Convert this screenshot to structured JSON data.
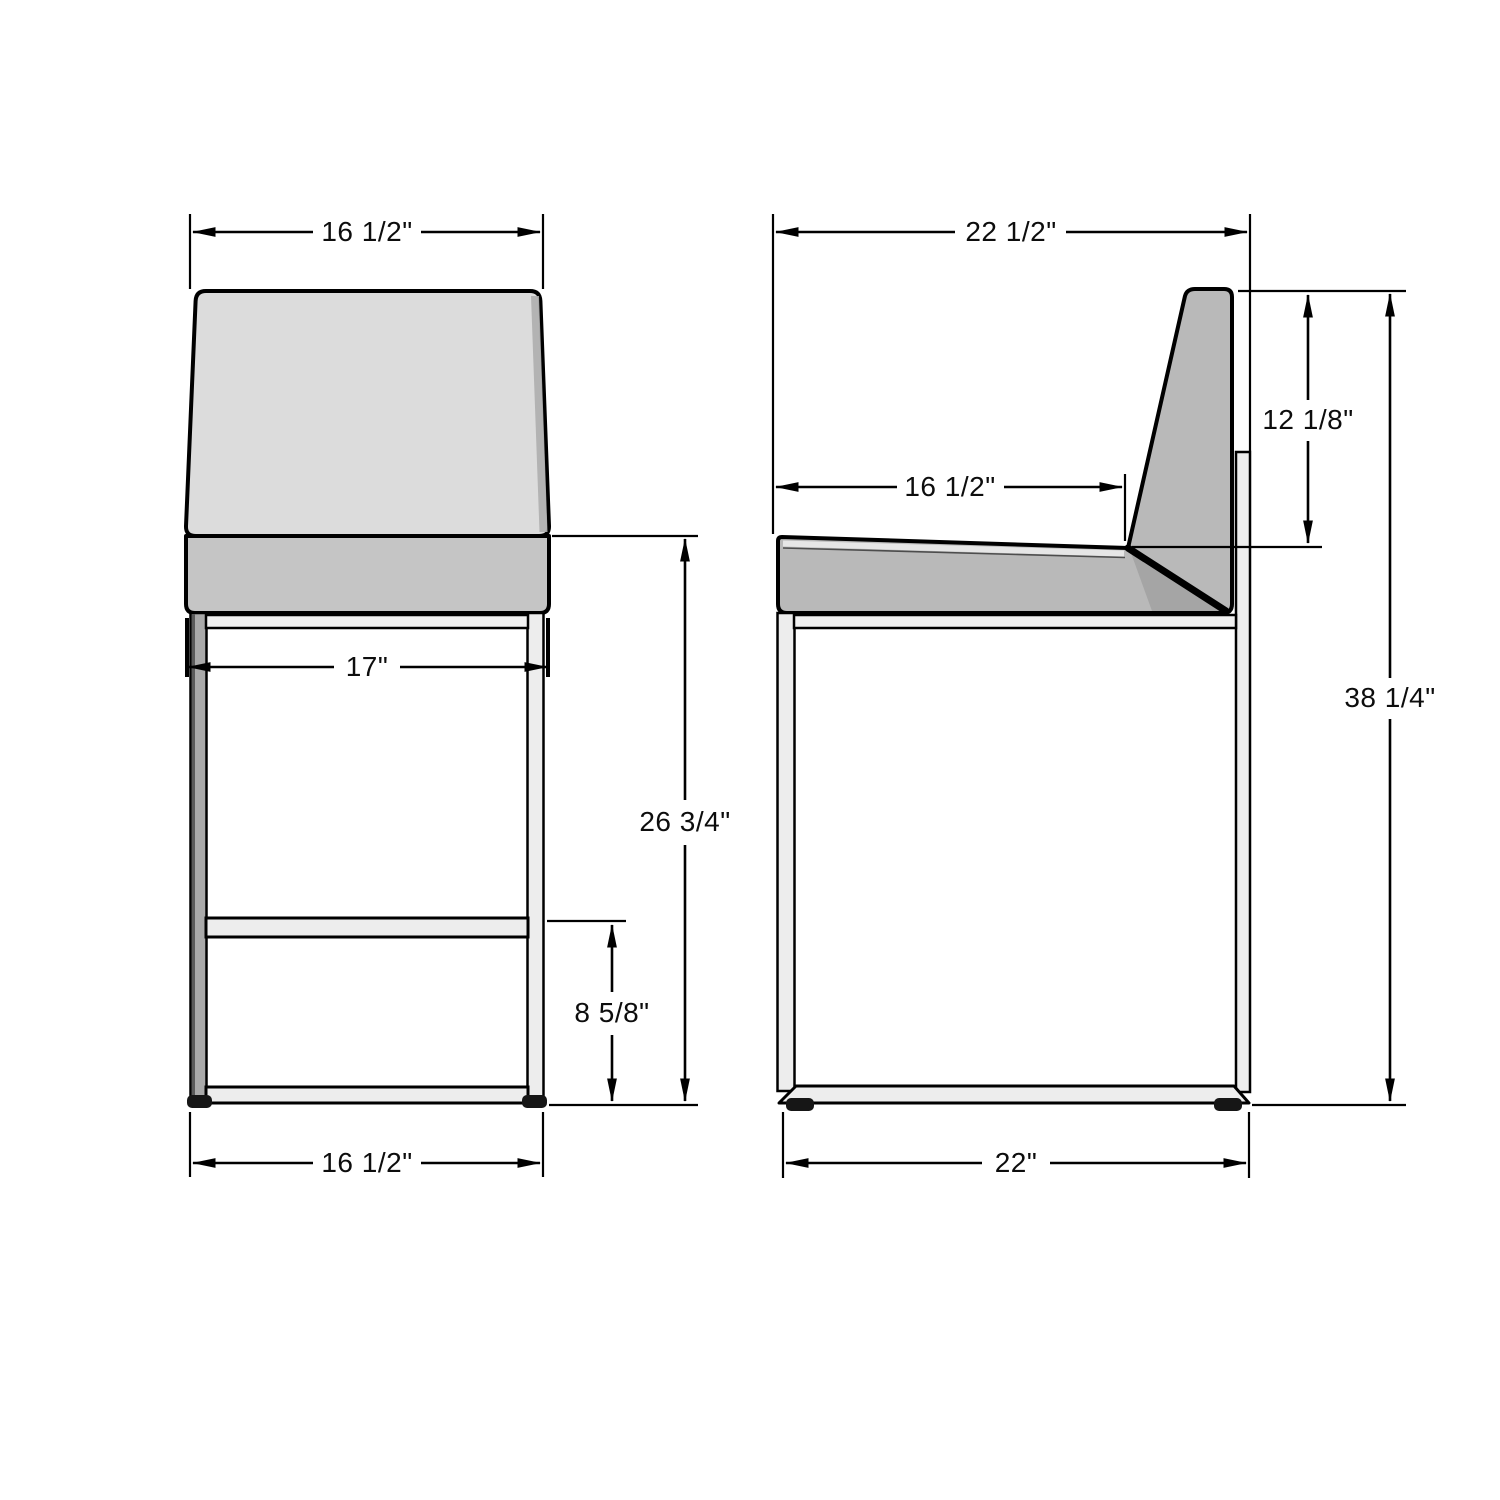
{
  "title": "Bar stool dimensional drawing, front and side views",
  "dims": {
    "front_top_width": "16 1/2\"",
    "front_seat_width": "17\"",
    "seat_height": "26 3/4\"",
    "footrest_height": "8 5/8\"",
    "front_bottom_width": "16 1/2\"",
    "overall_depth": "22 1/2\"",
    "seat_depth": "16 1/2\"",
    "backrest_height": "12 1/8\"",
    "overall_height": "38 1/4\"",
    "base_depth": "22\""
  },
  "colors": {
    "background": "#ffffff",
    "line": "#000000",
    "backrest_front": "#dcdcdc",
    "backrest_front_shade": "#aeaeae",
    "seat_front": "#c5c5c5",
    "cushion_side": "#b9b9b9",
    "cushion_side_shade": "#a5a5a5",
    "frame_light": "#ededed",
    "rail_light": "#f1f1f1",
    "leg_dark": "#a9a9a9",
    "foot": "#161616"
  }
}
